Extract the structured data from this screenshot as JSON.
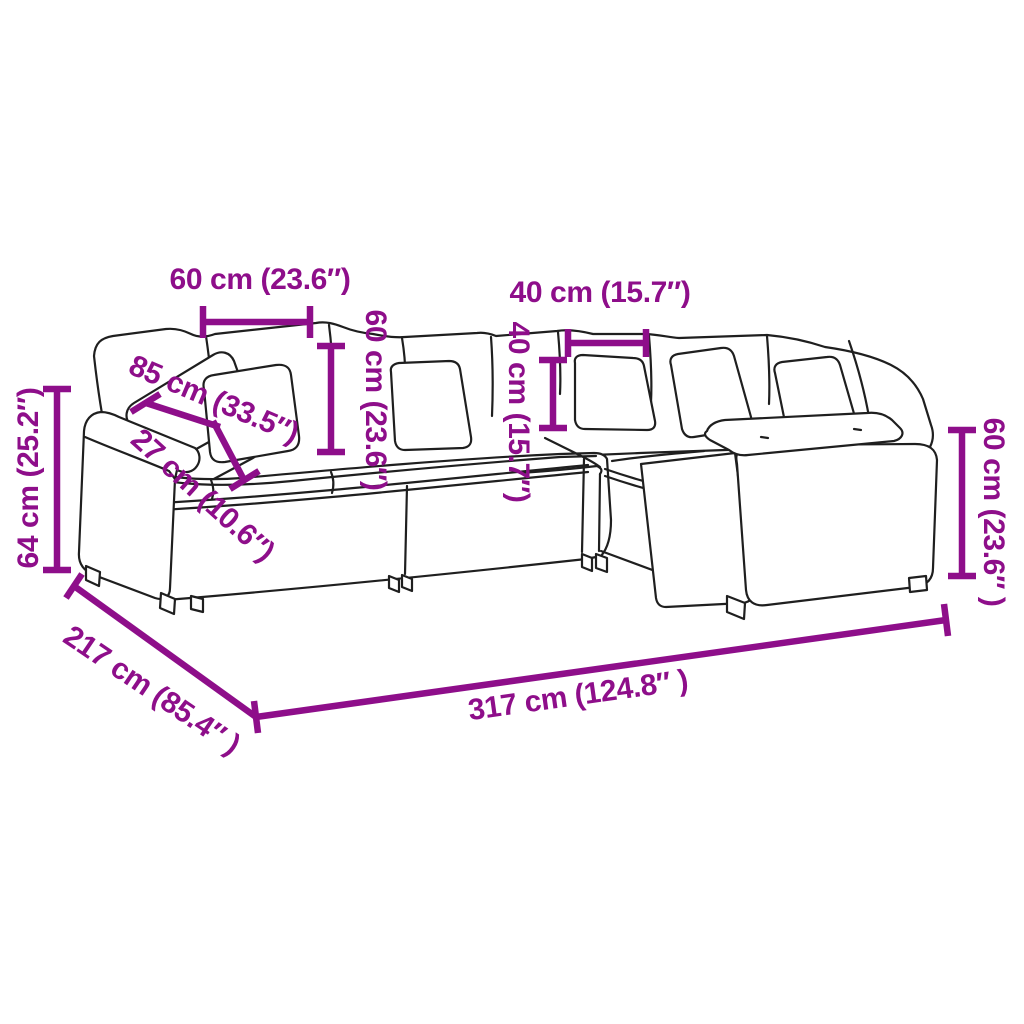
{
  "colors": {
    "accent": "#8E0E8A",
    "line": "#1f1f1f",
    "background": "#ffffff"
  },
  "diagram": {
    "subject": "Modular L-shaped corner sofa with cushions — dimension line drawing",
    "labels": {
      "width_60_top": "60 cm (23.6″)",
      "width_40_top": "40 cm (15.7″)",
      "height_60_back": "60 cm (23.6″)",
      "height_40_back": "40 cm (15.7″)",
      "depth_85_diagonal": "85 cm (33.5″)",
      "width_27_armrest": "27 cm (10.6″)",
      "height_64_left": "64 cm (25.2″)",
      "height_60_right": "60 cm (23.6″ )",
      "depth_217_total": "217 cm (85.4″ )",
      "width_317_total": "317 cm (124.8″ )"
    }
  }
}
